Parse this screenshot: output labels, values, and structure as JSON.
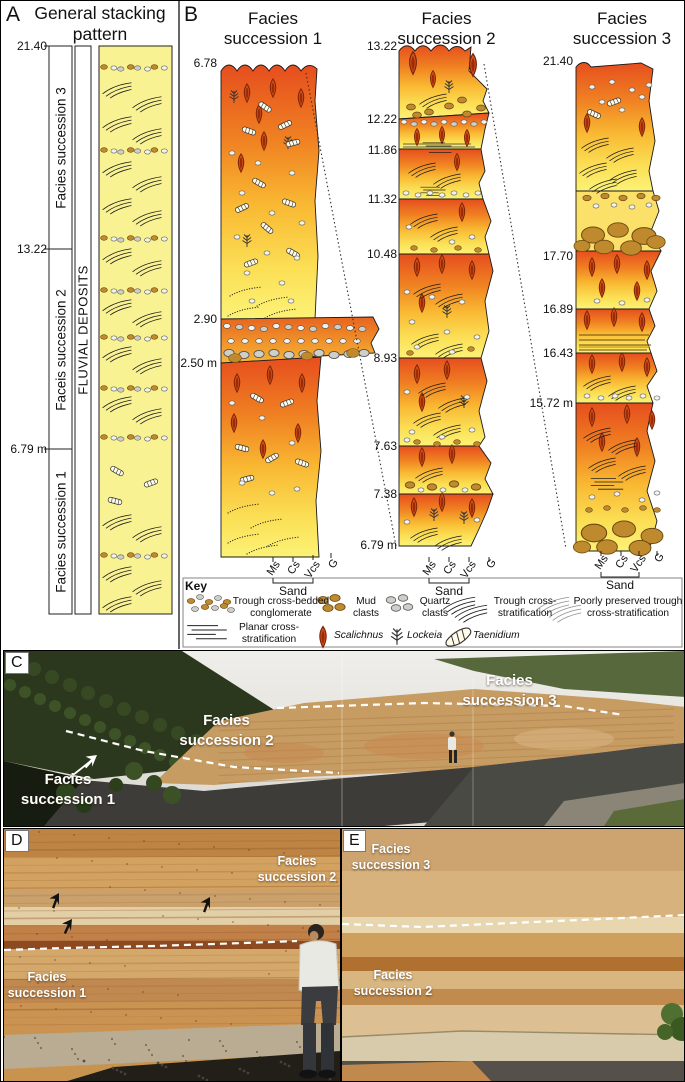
{
  "panel_a": {
    "label": "A",
    "title": "General stacking pattern",
    "depth_ticks": [
      "21.40",
      "13.22",
      "6.79 m"
    ],
    "successions": [
      "Facies  succession 3",
      "Faceis succession 2",
      "Facies succession 1"
    ],
    "deposit_label": "FLUVIAL DEPOSITS"
  },
  "panel_b": {
    "label": "B",
    "succession1": {
      "title": "Facies succession 1",
      "depths": [
        "6.78",
        "2.90",
        "2.50 m"
      ]
    },
    "succession2": {
      "title": "Facies succession 2",
      "depths": [
        "13.22",
        "12.22",
        "11.86",
        "11.32",
        "10.48",
        "8.93",
        "7.63",
        "7.38",
        "6.79 m"
      ]
    },
    "succession3": {
      "title": "Facies succession 3",
      "depths": [
        "21.40",
        "17.70",
        "16.89",
        "16.43",
        "15.72 m"
      ]
    },
    "grain_axis": {
      "ticks": [
        "Ms",
        "Cs",
        "Vcs",
        "G"
      ],
      "group_label": "Sand"
    }
  },
  "key": {
    "title": "Key",
    "items": {
      "conglomerate": "Trough cross-bedded conglomerate",
      "mud_clasts": "Mud clasts",
      "quartz_clasts": "Quartz clasts",
      "trough": "Trough cross-stratification",
      "poor_trough": "Poorly preserved trough cross-stratification",
      "planar": "Planar cross-stratification",
      "scalichnus": "Scalichnus",
      "lockeia": "Lockeia",
      "taenidium": "Taenidium"
    }
  },
  "panel_c": {
    "label": "C",
    "annotations": {
      "fs1": "Facies succession 1",
      "fs2": "Facies succession 2",
      "fs3": "Facies succession 3"
    }
  },
  "panel_d": {
    "label": "D",
    "annotations": {
      "fs2": "Facies succession 2",
      "fs1": "Facies succession 1"
    }
  },
  "panel_e": {
    "label": "E",
    "annotations": {
      "fs3": "Facies succession 3",
      "fs2": "Facies succession 2"
    }
  },
  "colors": {
    "unit_orange": "#e64e1e",
    "unit_yellow": "#fcf276",
    "stack_yellow": "#f8f292",
    "mud_brown": "#c08a30",
    "quartz_gray": "#cfcfca",
    "arrow_yellow": "#f2e205",
    "arrow_red": "#e01515",
    "contact_white": "#ffffff"
  }
}
